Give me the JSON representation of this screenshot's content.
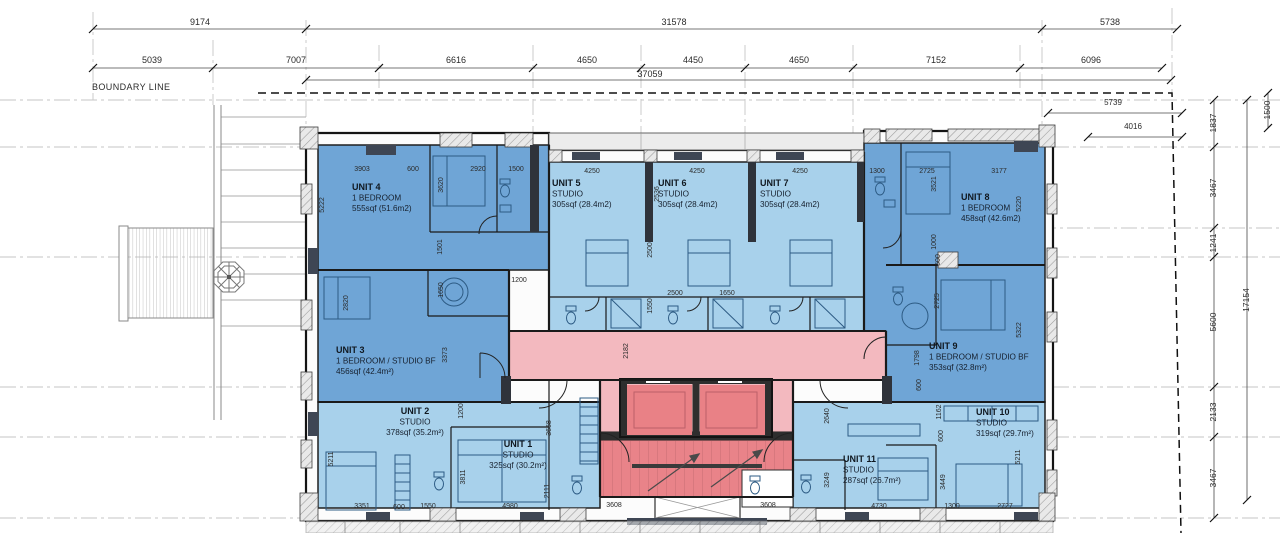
{
  "plan": {
    "boundary_label": "BOUNDARY LINE",
    "colors": {
      "unit_dark_blue": "#6FA5D6",
      "unit_light_blue": "#A8D1EB",
      "corridor_pink": "#F3B9BF",
      "core_red": "#E98389",
      "wall": "#1A1A1A"
    },
    "units": [
      {
        "id": "unit-4",
        "name": "UNIT 4",
        "type": "1 BEDROOM",
        "area": "555sqf (51.6m2)",
        "x": 352,
        "y": 190,
        "anchor": "start"
      },
      {
        "id": "unit-5",
        "name": "UNIT 5",
        "type": "STUDIO",
        "area": "305sqf (28.4m2)",
        "x": 552,
        "y": 186,
        "anchor": "start"
      },
      {
        "id": "unit-6",
        "name": "UNIT 6",
        "type": "STUDIO",
        "area": "305sqf (28.4m2)",
        "x": 658,
        "y": 186,
        "anchor": "start"
      },
      {
        "id": "unit-7",
        "name": "UNIT 7",
        "type": "STUDIO",
        "area": "305sqf (28.4m2)",
        "x": 760,
        "y": 186,
        "anchor": "start"
      },
      {
        "id": "unit-8",
        "name": "UNIT 8",
        "type": "1 BEDROOM",
        "area": "458sqf (42.6m2)",
        "x": 961,
        "y": 200,
        "anchor": "start"
      },
      {
        "id": "unit-3",
        "name": "UNIT 3",
        "type": "1 BEDROOM / STUDIO BF",
        "area": "456sqf (42.4m²)",
        "x": 336,
        "y": 353,
        "anchor": "start"
      },
      {
        "id": "unit-9",
        "name": "UNIT 9",
        "type": "1 BEDROOM / STUDIO BF",
        "area": "353sqf (32.8m²)",
        "x": 929,
        "y": 349,
        "anchor": "start"
      },
      {
        "id": "unit-2",
        "name": "UNIT 2",
        "type": "STUDIO",
        "area": "378sqf (35.2m²)",
        "x": 415,
        "y": 414,
        "anchor": "middle"
      },
      {
        "id": "unit-1",
        "name": "UNIT 1",
        "type": "STUDIO",
        "area": "325sqf (30.2m²)",
        "x": 518,
        "y": 447,
        "anchor": "middle"
      },
      {
        "id": "unit-10",
        "name": "UNIT 10",
        "type": "STUDIO",
        "area": "319sqf (29.7m²)",
        "x": 976,
        "y": 415,
        "anchor": "start"
      },
      {
        "id": "unit-11",
        "name": "UNIT 11",
        "type": "STUDIO",
        "area": "287sqf (26.7m²)",
        "x": 843,
        "y": 462,
        "anchor": "start"
      }
    ],
    "dims": [
      {
        "t": "9174",
        "x": 200,
        "y": 25,
        "s": 9
      },
      {
        "t": "31578",
        "x": 674,
        "y": 25,
        "s": 9
      },
      {
        "t": "5738",
        "x": 1110,
        "y": 25,
        "s": 9
      },
      {
        "t": "5039",
        "x": 152,
        "y": 63,
        "s": 9
      },
      {
        "t": "7007",
        "x": 296,
        "y": 63,
        "s": 9
      },
      {
        "t": "6616",
        "x": 456,
        "y": 63,
        "s": 9
      },
      {
        "t": "4650",
        "x": 587,
        "y": 63,
        "s": 9
      },
      {
        "t": "4450",
        "x": 693,
        "y": 63,
        "s": 9
      },
      {
        "t": "4650",
        "x": 799,
        "y": 63,
        "s": 9
      },
      {
        "t": "7152",
        "x": 936,
        "y": 63,
        "s": 9
      },
      {
        "t": "6096",
        "x": 1091,
        "y": 63,
        "s": 9
      },
      {
        "t": "37059",
        "x": 650,
        "y": 77,
        "s": 9
      },
      {
        "t": "5739",
        "x": 1113,
        "y": 105,
        "s": 8
      },
      {
        "t": "4016",
        "x": 1133,
        "y": 129,
        "s": 8
      },
      {
        "t": "1837",
        "x": 1216,
        "y": 123,
        "r": 1,
        "s": 8.5
      },
      {
        "t": "3467",
        "x": 1216,
        "y": 188,
        "r": 1,
        "s": 8.5
      },
      {
        "t": "1241",
        "x": 1216,
        "y": 243,
        "r": 1,
        "s": 8.5
      },
      {
        "t": "5600",
        "x": 1216,
        "y": 322,
        "r": 1,
        "s": 8.5
      },
      {
        "t": "2133",
        "x": 1216,
        "y": 412,
        "r": 1,
        "s": 8.5
      },
      {
        "t": "3467",
        "x": 1216,
        "y": 478,
        "r": 1,
        "s": 8.5
      },
      {
        "t": "17154",
        "x": 1249,
        "y": 300,
        "r": 1,
        "s": 8.5
      },
      {
        "t": "1500",
        "x": 1270,
        "y": 110,
        "r": 1,
        "s": 8.5
      },
      {
        "t": "3903",
        "x": 362,
        "y": 171
      },
      {
        "t": "600",
        "x": 413,
        "y": 171
      },
      {
        "t": "2920",
        "x": 478,
        "y": 171
      },
      {
        "t": "1500",
        "x": 516,
        "y": 171
      },
      {
        "t": "5222",
        "x": 324,
        "y": 205,
        "r": 1
      },
      {
        "t": "3620",
        "x": 443,
        "y": 185,
        "r": 1
      },
      {
        "t": "1501",
        "x": 442,
        "y": 247,
        "r": 1
      },
      {
        "t": "4250",
        "x": 592,
        "y": 173
      },
      {
        "t": "4250",
        "x": 697,
        "y": 173
      },
      {
        "t": "4250",
        "x": 800,
        "y": 173
      },
      {
        "t": "2536",
        "x": 659,
        "y": 194,
        "r": 1
      },
      {
        "t": "2500",
        "x": 652,
        "y": 250,
        "r": 1
      },
      {
        "t": "2500",
        "x": 675,
        "y": 295
      },
      {
        "t": "1650",
        "x": 727,
        "y": 295
      },
      {
        "t": "1550",
        "x": 652,
        "y": 306,
        "r": 1
      },
      {
        "t": "1300",
        "x": 877,
        "y": 173
      },
      {
        "t": "2725",
        "x": 927,
        "y": 173
      },
      {
        "t": "3177",
        "x": 999,
        "y": 173
      },
      {
        "t": "3521",
        "x": 936,
        "y": 184,
        "r": 1
      },
      {
        "t": "5220",
        "x": 1021,
        "y": 204,
        "r": 1
      },
      {
        "t": "1000",
        "x": 936,
        "y": 242,
        "r": 1
      },
      {
        "t": "600",
        "x": 940,
        "y": 260,
        "r": 1
      },
      {
        "t": "2820",
        "x": 348,
        "y": 303,
        "r": 1
      },
      {
        "t": "1650",
        "x": 443,
        "y": 290,
        "r": 1
      },
      {
        "t": "3373",
        "x": 447,
        "y": 355,
        "r": 1
      },
      {
        "t": "1200",
        "x": 519,
        "y": 282
      },
      {
        "t": "2725",
        "x": 939,
        "y": 301,
        "r": 1
      },
      {
        "t": "5322",
        "x": 1021,
        "y": 330,
        "r": 1
      },
      {
        "t": "1798",
        "x": 919,
        "y": 358,
        "r": 1
      },
      {
        "t": "600",
        "x": 921,
        "y": 385,
        "r": 1
      },
      {
        "t": "2182",
        "x": 628,
        "y": 351,
        "r": 1
      },
      {
        "t": "1200",
        "x": 463,
        "y": 411,
        "r": 1
      },
      {
        "t": "5211",
        "x": 333,
        "y": 459,
        "r": 1
      },
      {
        "t": "3811",
        "x": 465,
        "y": 477,
        "r": 1
      },
      {
        "t": "3668",
        "x": 551,
        "y": 428,
        "r": 1
      },
      {
        "t": "2111",
        "x": 549,
        "y": 491,
        "r": 1
      },
      {
        "t": "3351",
        "x": 362,
        "y": 508
      },
      {
        "t": "600",
        "x": 399,
        "y": 509
      },
      {
        "t": "1550",
        "x": 428,
        "y": 508
      },
      {
        "t": "4980",
        "x": 510,
        "y": 508
      },
      {
        "t": "3608",
        "x": 614,
        "y": 507
      },
      {
        "t": "3608",
        "x": 768,
        "y": 507
      },
      {
        "t": "2640",
        "x": 829,
        "y": 416,
        "r": 1
      },
      {
        "t": "3249",
        "x": 829,
        "y": 480,
        "r": 1
      },
      {
        "t": "1162",
        "x": 941,
        "y": 412,
        "r": 1
      },
      {
        "t": "600",
        "x": 943,
        "y": 436,
        "r": 1
      },
      {
        "t": "3449",
        "x": 945,
        "y": 482,
        "r": 1
      },
      {
        "t": "5211",
        "x": 1020,
        "y": 457,
        "r": 1
      },
      {
        "t": "4730",
        "x": 879,
        "y": 508
      },
      {
        "t": "1300",
        "x": 952,
        "y": 508
      },
      {
        "t": "2727",
        "x": 1005,
        "y": 508
      }
    ]
  }
}
